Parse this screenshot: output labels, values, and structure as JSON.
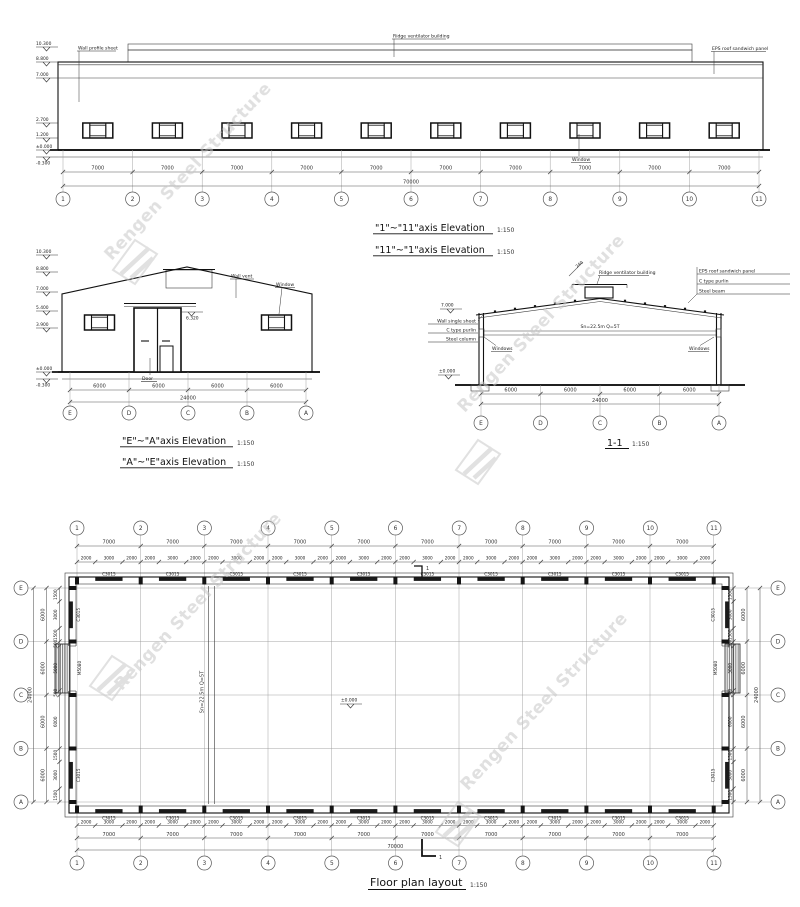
{
  "watermark": {
    "text": "Rengen Steel Structure"
  },
  "dims": {
    "d500": "500",
    "d1500": "1500",
    "d2000": "2000",
    "d3000": "3000",
    "d5000": "5000",
    "d6000": "6000",
    "d7000": "7000",
    "d24000": "24000",
    "d70000": "70000"
  },
  "top_elevation": {
    "title": "\"1\"~\"11\"axis Elevation",
    "title_alt": "\"11\"~\"1\"axis Elevation",
    "scale": "1:150",
    "levels": [
      "10.300",
      "8.800",
      "7.000",
      "2.700",
      "1.200",
      "±0.000",
      "-0.300"
    ],
    "labels": {
      "wall_sheet": "Wall profile sheet",
      "ridge_vent": "Ridge ventilator building",
      "eps_panel": "EPS roof sandwich panel",
      "window": "Window"
    },
    "bays": [
      "7000"
    ],
    "total": "70000",
    "axes": [
      "1",
      "2",
      "3",
      "4",
      "5",
      "6",
      "7",
      "8",
      "9",
      "10",
      "11"
    ]
  },
  "gable_elevation": {
    "title": "\"E\"~\"A\"axis Elevation",
    "title_alt": "\"A\"~\"E\"axis Elevation",
    "scale": "1:150",
    "levels": [
      "10.300",
      "8.800",
      "7.000",
      "5.400",
      "3.900",
      "±0.000",
      "-0.300"
    ],
    "canopy_level": "6.320",
    "labels": {
      "wall_vent": "Wall vent",
      "window": "Window",
      "door": "Door"
    },
    "bays": [
      "6000"
    ],
    "total": "24000",
    "axes": [
      "E",
      "D",
      "C",
      "B",
      "A"
    ]
  },
  "section": {
    "title": "1-1",
    "scale": "1:150",
    "right_labels": [
      "EPS roof sandwich panel",
      "C type purlin",
      "Steel beam"
    ],
    "left_labels": [
      "Wall single sheet",
      "C type purlin",
      "Steel column"
    ],
    "ridge_label": "Ridge ventilator building",
    "ridge_dim": "240",
    "crane_label": "Sn=22.5m Q=5T",
    "windows_label": "Windows",
    "levels": {
      "eave": "7.000",
      "ground": "±0.000"
    },
    "bays": [
      "6000"
    ],
    "total": "24000",
    "axes": [
      "E",
      "D",
      "C",
      "B",
      "A"
    ]
  },
  "floor_plan": {
    "title": "Floor plan layout",
    "scale": "1:150",
    "col_axes": [
      "1",
      "2",
      "3",
      "4",
      "5",
      "6",
      "7",
      "8",
      "9",
      "10",
      "11"
    ],
    "row_axes": [
      "E",
      "D",
      "C",
      "B",
      "A"
    ],
    "bays": [
      "7000"
    ],
    "subs": [
      "2000",
      "3000",
      "2000"
    ],
    "total": "70000",
    "side_bay": [
      "6000"
    ],
    "side_total": "24000",
    "window_tag": "C3015",
    "door_tag": "M5080",
    "crane_label": "Sn=22.5m Q=5T",
    "level": "±0.000",
    "section_no": "1"
  }
}
